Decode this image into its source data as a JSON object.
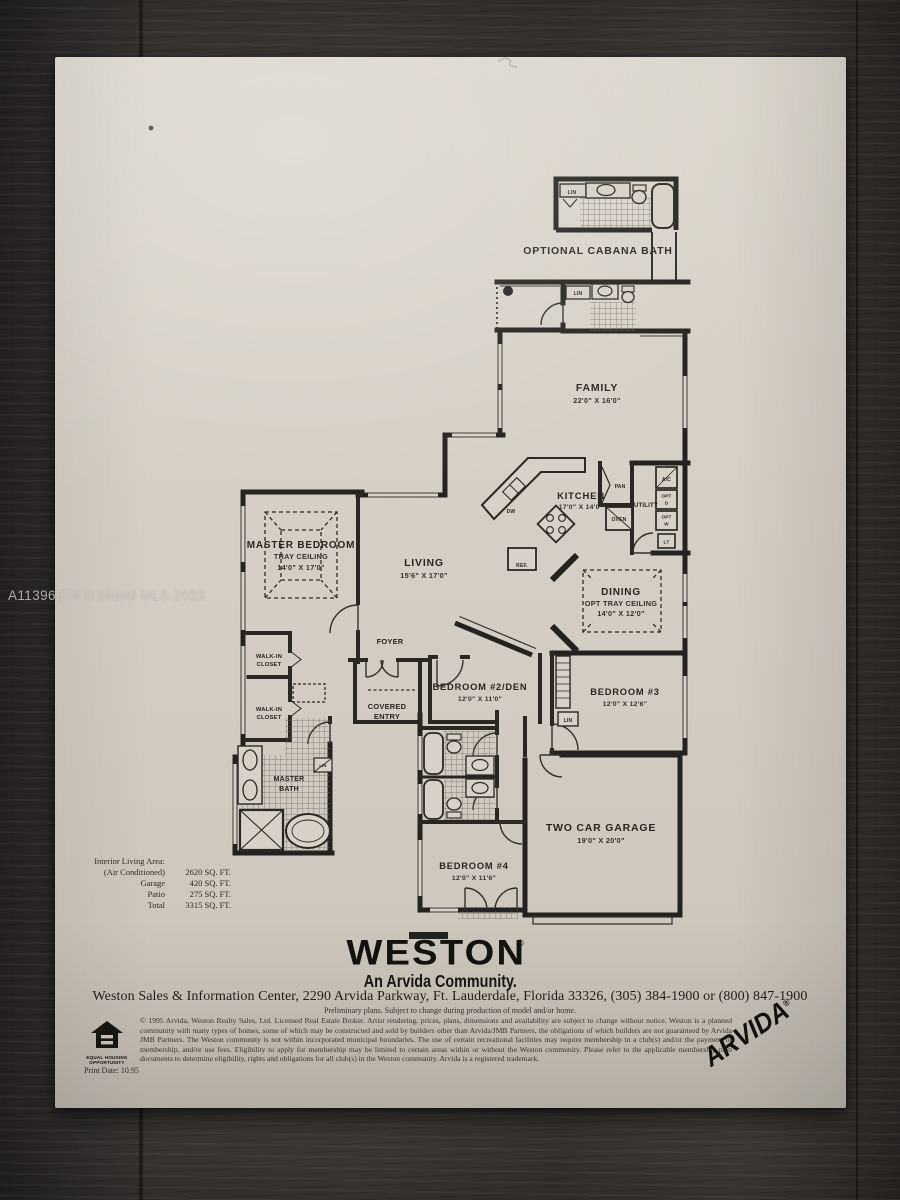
{
  "watermark": "A11396374 © Miami MLS 2023",
  "plan": {
    "cabana_label": "OPTIONAL CABANA BATH",
    "rooms": {
      "family": {
        "name": "FAMILY",
        "dims": "22'0\" X 16'0\""
      },
      "kitchen": {
        "name": "KITCHEN",
        "dims": "17'0\" X 14'0\""
      },
      "living": {
        "name": "LIVING",
        "dims": "15'6\" X 17'0\""
      },
      "master_bedroom": {
        "name": "MASTER BEDROOM",
        "sub": "TRAY CEILING",
        "dims": "14'0\" X 17'0\""
      },
      "dining": {
        "name": "DINING",
        "sub": "OPT TRAY CEILING",
        "dims": "14'0\" X 12'0\""
      },
      "foyer": {
        "name": "FOYER"
      },
      "covered_entry": {
        "line1": "COVERED",
        "line2": "ENTRY"
      },
      "bedroom2": {
        "name": "BEDROOM #2/DEN",
        "dims": "12'0\" X 11'0\""
      },
      "bedroom3": {
        "name": "BEDROOM #3",
        "dims": "12'0\" X 12'6\""
      },
      "bedroom4": {
        "name": "BEDROOM #4",
        "dims": "12'0\" X 11'6\""
      },
      "garage": {
        "name": "TWO CAR GARAGE",
        "dims": "19'0\" X 20'0\""
      },
      "master_bath": {
        "line1": "MASTER",
        "line2": "BATH"
      },
      "walkin_closet": {
        "line1": "WALK-IN",
        "line2": "CLOSET"
      }
    },
    "fixtures": {
      "lin": "LIN",
      "pan": "PAN",
      "oven": "OVEN",
      "dw": "DW",
      "ref": "REF.",
      "utility": "UTILITY",
      "boxes": [
        {
          "l1": "A/C",
          "l2": ""
        },
        {
          "l1": "OPT",
          "l2": "D"
        },
        {
          "l1": "OPT",
          "l2": "W"
        },
        {
          "l1": "LT",
          "l2": ""
        }
      ]
    }
  },
  "areas": {
    "rows": [
      {
        "label": "Interior Living Area:",
        "value": ""
      },
      {
        "label": "(Air Conditioned)",
        "value": "2620 SQ. FT."
      },
      {
        "label": "Garage",
        "value": "420 SQ. FT."
      },
      {
        "label": "Patio",
        "value": "275 SQ. FT."
      },
      {
        "label": "Total",
        "value": "3315 SQ. FT."
      }
    ]
  },
  "footer": {
    "brand": "WESTON",
    "brand_reg": "®",
    "tagline": "An Arvida Community.",
    "address": "Weston Sales & Information Center, 2290 Arvida Parkway, Ft. Lauderdale, Florida 33326, (305) 384-1900 or (800) 847-1900",
    "preliminary": "Preliminary plans. Subject to change during production of model and/or home.",
    "legal": "© 1995 Arvida, Weston Realty Sales, Ltd. Licensed Real Estate Broker. Artist rendering, prices, plans, dimensions and availability are subject to change without notice. Weston is a planned community with many types of homes, some of which may be constructed and sold by builders other than Arvida/JMB Partners, the obligations of which builders are not guaranteed by Arvida JMB Partners. The Weston community is not within incorporated municipal boundaries. The use of certain recreational facilities may require membership in a club(s) and/or the payment of membership, and/or use fees. Eligibility to apply for membership may be limited to certain areas within or without the Weston community. Please refer to the applicable membership plan documents to determine eligibility, rights and obligations for all club(s) in the Weston community. Arvida is a registered trademark.",
    "eho_line1": "EQUAL HOUSING",
    "eho_line2": "OPPORTUNITY",
    "print_date": "Print Date: 10.95",
    "arvida": "ARVIDA",
    "arvida_reg": "®"
  }
}
